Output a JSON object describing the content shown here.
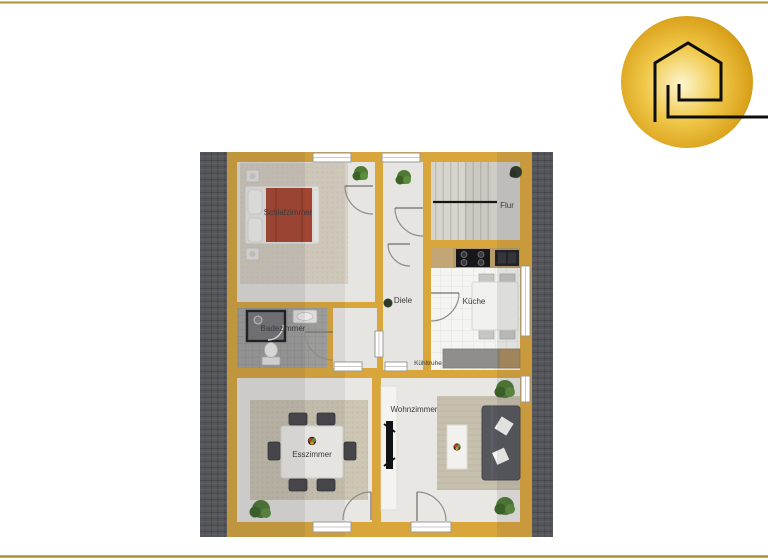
{
  "page": {
    "type": "floor-plan-presentation",
    "border_line_color": "#a99238",
    "background": "#ffffff"
  },
  "logo": {
    "icon": "house-spiral-icon",
    "shape": "gold-circle-with-line-to-right-edge",
    "colors": {
      "outer_gold": "#c08e0e",
      "mid_gold": "#e8b832",
      "center_glow": "#fdf6d0",
      "line": "#0d0d0d"
    }
  },
  "floorplan": {
    "rooms": {
      "schlafzimmer": {
        "label": "Schlafzimmer"
      },
      "flur": {
        "label": "Flur"
      },
      "diele": {
        "label": "Diele"
      },
      "kueche": {
        "label": "Küche"
      },
      "badezimmer": {
        "label": "Badezimmer"
      },
      "esszimmer": {
        "label": "Esszimmer"
      },
      "wohnzimmer": {
        "label": "Wohnzimmer"
      }
    },
    "annotations": {
      "kuehltruhe": {
        "label": "Kühltruhe"
      }
    },
    "colors": {
      "wall_gold": "#d9a63c",
      "roof_hatch_gray": "#57585c",
      "hall_floor": "#e6e5e2",
      "kitchen_tile": "#f4f4f1",
      "bath_tile": "#a3a3a1",
      "bed_blanket_red": "#ad4630",
      "sofa_gray": "#56575c",
      "plant_green": "#4e7a33"
    }
  }
}
